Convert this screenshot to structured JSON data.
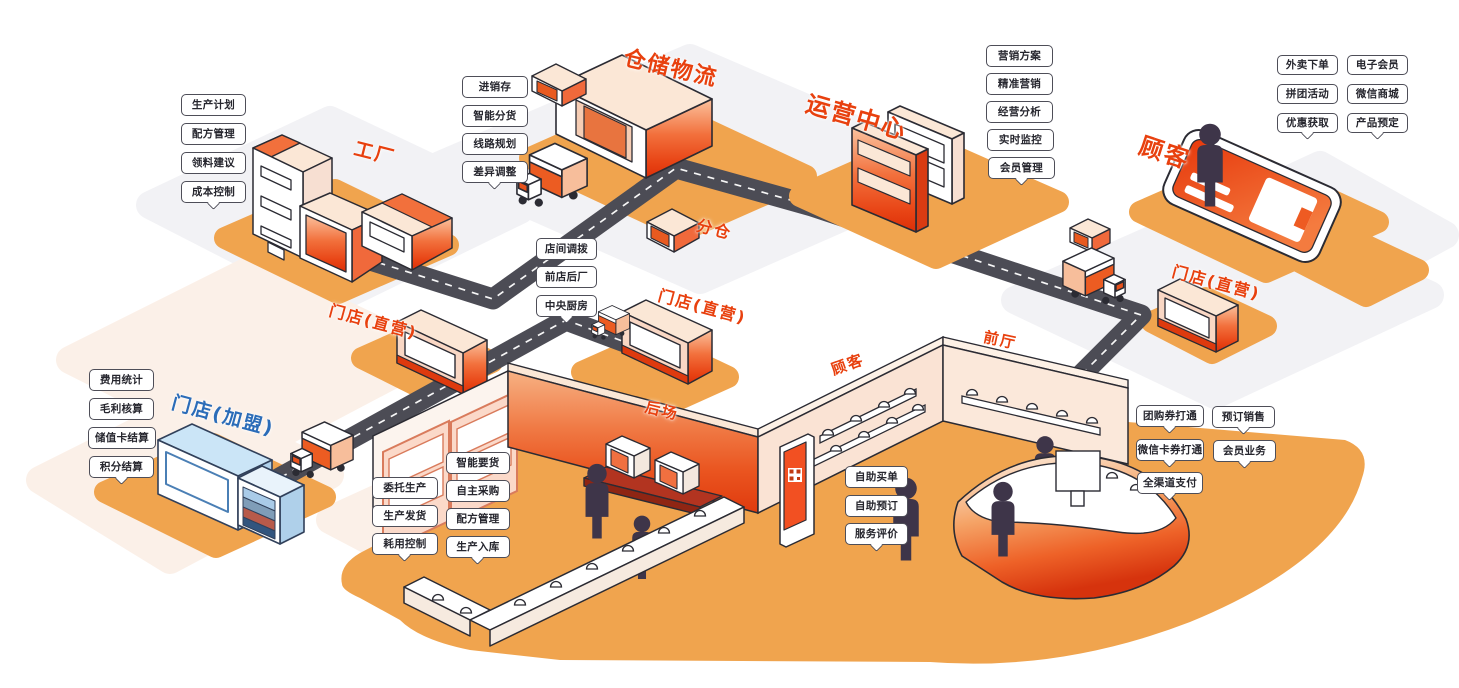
{
  "canvas": {
    "width": 1459,
    "height": 688
  },
  "colors": {
    "accent_orange": "#E8400E",
    "franchise_blue": "#2B6CB8",
    "road_gray": "#4C4C55",
    "pad_orange": "#F0A44E"
  },
  "nodes": {
    "factory": {
      "title": "工厂",
      "labels": [
        "生产计划",
        "配方管理",
        "领料建议",
        "成本控制"
      ]
    },
    "warehouse": {
      "title": "仓储物流",
      "labels": [
        "进销存",
        "智能分货",
        "线路规划",
        "差异调整"
      ]
    },
    "sub_warehouse": {
      "title": "分仓"
    },
    "operations": {
      "title": "运营中心",
      "labels": [
        "营销方案",
        "精准营销",
        "经营分析",
        "实时监控",
        "会员管理"
      ]
    },
    "customer_online": {
      "title": "顾客",
      "labels": [
        "外卖下单",
        "电子会员",
        "拼团活动",
        "微信商城",
        "优惠获取",
        "产品预定"
      ]
    },
    "store_left": {
      "title": "门店(直营)"
    },
    "store_center": {
      "title": "门店(直营)"
    },
    "store_right": {
      "title": "门店(直营)"
    },
    "franchise": {
      "title": "门店(加盟)",
      "labels": [
        "费用统计",
        "毛利核算",
        "储值卡结算",
        "积分结算"
      ]
    },
    "transfer": {
      "labels": [
        "店间调拨",
        "前店后厂",
        "中央厨房"
      ]
    },
    "production_left": {
      "labels": [
        "委托生产",
        "生产发货",
        "耗用控制"
      ]
    },
    "production_right": {
      "labels": [
        "智能要货",
        "自主采购",
        "配方管理",
        "生产入库"
      ]
    },
    "self_service": {
      "labels": [
        "自助买单",
        "自助预订",
        "服务评价"
      ]
    },
    "payment": {
      "labels": [
        "团购券打通",
        "微信卡券打通",
        "全渠道支付"
      ]
    },
    "sales": {
      "labels": [
        "预订销售",
        "会员业务"
      ]
    },
    "backstage": {
      "title": "后场"
    },
    "customer_area": {
      "title": "顾客"
    },
    "front_hall": {
      "title": "前厅"
    }
  }
}
